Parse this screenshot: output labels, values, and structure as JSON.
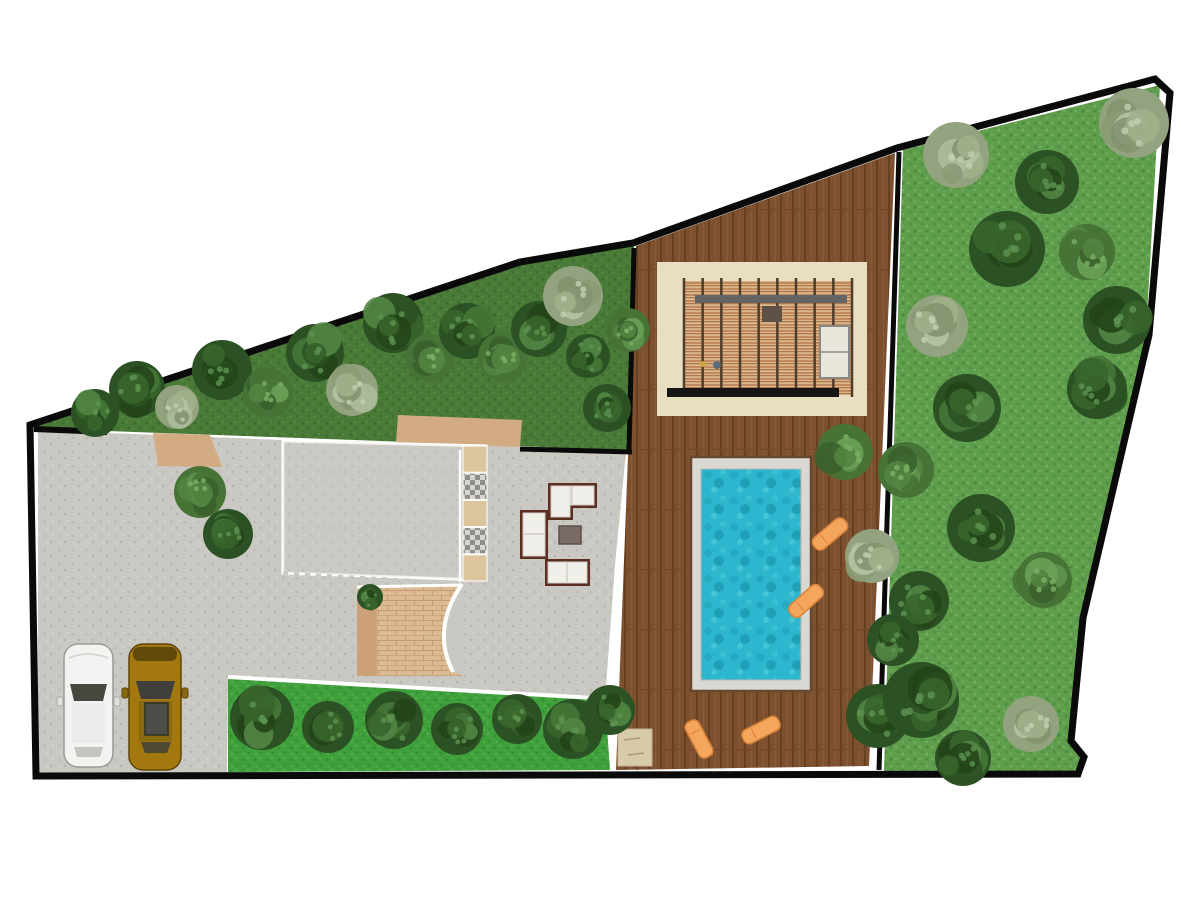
{
  "meta": {
    "type": "landscape-site-plan",
    "view": "top-down",
    "background": "#ffffff"
  },
  "palette": {
    "outline": "#0a0a0a",
    "paving": "#c9c8c2",
    "terrace_tint": "#cecdc7",
    "lawn_dark": "#4a7a38",
    "lawn_bright": "#3fa03c",
    "lawn_garden": "#5f9e4d",
    "deck": "#7d5130",
    "deck_plank": "#67401f",
    "pool_water": "#2db7cf",
    "pool_band": "#d9d8d2",
    "pool_frame": "#67482c",
    "pergola_pad": "#e9ddc2",
    "pergola_wood": "#c08a5e",
    "pergola_beam": "#646464",
    "pergola_bar": "#151515",
    "lounger": "#f5a55c",
    "lounger_edge": "#d9823c",
    "path_tan": "#d2ab83",
    "path_brick": "#dcba92",
    "tile_tan": "#dcc49c",
    "sofa_frame": "#5c2e22",
    "sofa_cushion": "#f1efe9",
    "table": "#7b6b67",
    "car_white": "#f3f3f1",
    "car_gold": "#a3780f",
    "glass": "#47473f",
    "pad_beige": "#d8cbaa",
    "white_line": "#ffffff"
  },
  "boundary": {
    "stroke_width": 7,
    "points": "30,425 520,262 633,243 897,148 1155,79 1170,93 1149,335 1083,618 1071,741 1084,757 1078,774 36,776"
  },
  "areas": [
    {
      "name": "front-courtyard-paving",
      "fill": "paving"
    },
    {
      "name": "perimeter-lawn-top",
      "fill": "lawn_dark"
    },
    {
      "name": "lawn-strip-bottom",
      "fill": "lawn_bright"
    },
    {
      "name": "side-garden-right",
      "fill": "lawn_garden"
    },
    {
      "name": "wood-deck",
      "fill": "deck"
    },
    {
      "name": "paved-terrace",
      "fill": "paving"
    }
  ],
  "pool": {
    "x": 691,
    "y": 457,
    "w": 120,
    "h": 234,
    "water_x": 701,
    "water_y": 469,
    "water_w": 100,
    "water_h": 211
  },
  "pergola": {
    "pad": [
      657,
      262,
      210,
      154
    ],
    "structure": [
      684,
      281,
      168,
      114
    ],
    "posts": 10,
    "beam_y": 295,
    "bar": [
      667,
      388,
      172,
      9
    ]
  },
  "cars": [
    {
      "id": "white-suv",
      "body": "car_white",
      "x": 64,
      "y": 644,
      "w": 49,
      "h": 123
    },
    {
      "id": "gold-suv",
      "body": "car_gold",
      "x": 129,
      "y": 644,
      "w": 52,
      "h": 126
    }
  ],
  "loungers": {
    "count": 4,
    "w": 40,
    "h": 15,
    "items": [
      {
        "x": 830,
        "y": 534,
        "rot": -40
      },
      {
        "x": 806,
        "y": 601,
        "rot": -42
      },
      {
        "x": 699,
        "y": 739,
        "rot": 62
      },
      {
        "x": 761,
        "y": 730,
        "rot": -27
      }
    ]
  },
  "lounge_set": {
    "sofas": 3,
    "tables": 1,
    "l_sofa": {
      "x": 548,
      "y": 483
    },
    "side_sofa": {
      "x": 520,
      "y": 510
    },
    "front_sofa": {
      "x": 545,
      "y": 559
    },
    "coffee_table": {
      "x": 559,
      "y": 526,
      "w": 22,
      "h": 18
    }
  },
  "tile_strip": {
    "x": 463,
    "y": 446,
    "cell_w": 24,
    "cell_h": 27.2,
    "cells": [
      "tan",
      "checker",
      "tan",
      "checker",
      "tan"
    ]
  },
  "stepping_pad": {
    "x": 618,
    "y": 729,
    "w": 34,
    "h": 37
  },
  "paths": {
    "top_walk": "396,443 398,415 522,420 520,447",
    "left_wedge": "153,433 210,435 222,467 158,466",
    "brick_path": [
      357,
      586,
      105,
      90
    ]
  },
  "tree_tones": {
    "d": {
      "base": "#2c5124",
      "blobs": [
        "#234419",
        "#38652c",
        "#457737",
        "#2c5124",
        "#528544"
      ],
      "speck": "#5d9350"
    },
    "m": {
      "base": "#477336",
      "blobs": [
        "#3a612c",
        "#538441",
        "#5f934c",
        "#477336",
        "#6aa156"
      ],
      "speck": "#7bb065"
    },
    "s": {
      "base": "#93a37f",
      "blobs": [
        "#83936f",
        "#a0b08c",
        "#adbb9a",
        "#8b9b77",
        "#b6c3a4"
      ],
      "speck": "#c2cfb0"
    }
  },
  "trees": {
    "count": 46,
    "items": [
      [
        95,
        413,
        24,
        "d"
      ],
      [
        137,
        389,
        28,
        "d"
      ],
      [
        177,
        407,
        22,
        "s"
      ],
      [
        222,
        370,
        30,
        "d"
      ],
      [
        268,
        393,
        25,
        "m"
      ],
      [
        315,
        353,
        29,
        "d"
      ],
      [
        352,
        390,
        26,
        "s"
      ],
      [
        393,
        323,
        30,
        "d"
      ],
      [
        430,
        358,
        24,
        "m"
      ],
      [
        467,
        331,
        28,
        "d"
      ],
      [
        503,
        357,
        25,
        "m"
      ],
      [
        539,
        329,
        28,
        "d"
      ],
      [
        573,
        296,
        30,
        "s"
      ],
      [
        588,
        356,
        22,
        "d"
      ],
      [
        607,
        408,
        24,
        "d"
      ],
      [
        628,
        330,
        22,
        "m"
      ],
      [
        200,
        492,
        26,
        "m"
      ],
      [
        228,
        534,
        25,
        "d"
      ],
      [
        370,
        597,
        13,
        "d"
      ],
      [
        262,
        718,
        32,
        "d"
      ],
      [
        328,
        727,
        26,
        "d"
      ],
      [
        394,
        720,
        29,
        "d"
      ],
      [
        457,
        729,
        26,
        "d"
      ],
      [
        517,
        719,
        25,
        "d"
      ],
      [
        573,
        729,
        30,
        "d"
      ],
      [
        610,
        710,
        25,
        "d"
      ],
      [
        845,
        452,
        28,
        "m"
      ],
      [
        872,
        556,
        27,
        "s"
      ],
      [
        893,
        640,
        26,
        "d"
      ],
      [
        878,
        716,
        32,
        "d"
      ],
      [
        956,
        155,
        33,
        "s"
      ],
      [
        1134,
        123,
        35,
        "s"
      ],
      [
        1047,
        182,
        32,
        "d"
      ],
      [
        1007,
        249,
        38,
        "d"
      ],
      [
        1117,
        320,
        34,
        "d"
      ],
      [
        937,
        326,
        31,
        "s"
      ],
      [
        967,
        408,
        34,
        "d"
      ],
      [
        1097,
        389,
        30,
        "d"
      ],
      [
        906,
        470,
        28,
        "m"
      ],
      [
        981,
        528,
        34,
        "d"
      ],
      [
        1044,
        580,
        28,
        "m"
      ],
      [
        919,
        601,
        30,
        "d"
      ],
      [
        921,
        700,
        38,
        "d"
      ],
      [
        1031,
        724,
        28,
        "s"
      ],
      [
        963,
        758,
        28,
        "d"
      ],
      [
        1087,
        252,
        28,
        "m"
      ]
    ]
  }
}
